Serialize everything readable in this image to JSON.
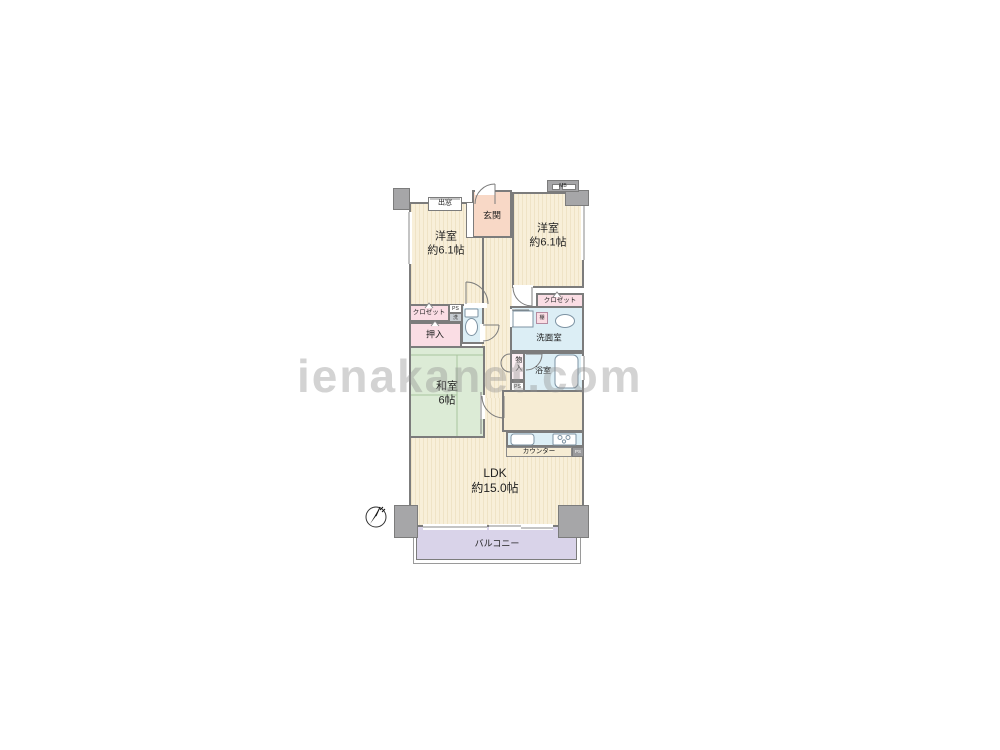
{
  "watermark": "ienakanet.com",
  "rooms": {
    "western_a": {
      "name": "洋室",
      "size": "約6.1帖"
    },
    "western_b": {
      "name": "洋室",
      "size": "約6.1帖"
    },
    "japanese": {
      "name": "和室",
      "size": "6帖"
    },
    "ldk": {
      "name": "LDK",
      "size": "約15.0帖"
    },
    "entrance": {
      "name": "玄関"
    },
    "washroom": {
      "name": "洗面室"
    },
    "bathroom": {
      "name": "浴室"
    },
    "balcony": {
      "name": "バルコニー"
    }
  },
  "storage": {
    "closet_a": "クロゼット",
    "closet_b": "クロゼット",
    "oshiire": "押入",
    "mono_ire": "物入",
    "shelf": "棚"
  },
  "features": {
    "bay_window": "出窓",
    "counter": "カウンター",
    "meter_box": "MB",
    "pipe_space_1": "PS",
    "pipe_space_2": "PS",
    "pipe_space_3": "PS",
    "laundry": "洗"
  },
  "colors": {
    "wall": "#7c7c7c",
    "flooring": "#f8efd9",
    "tatami": "#dcebd6",
    "wet_area": "#dceef5",
    "closet": "#fadde4",
    "entrance": "#f8d8c6",
    "balcony": "#d9d3e9"
  }
}
